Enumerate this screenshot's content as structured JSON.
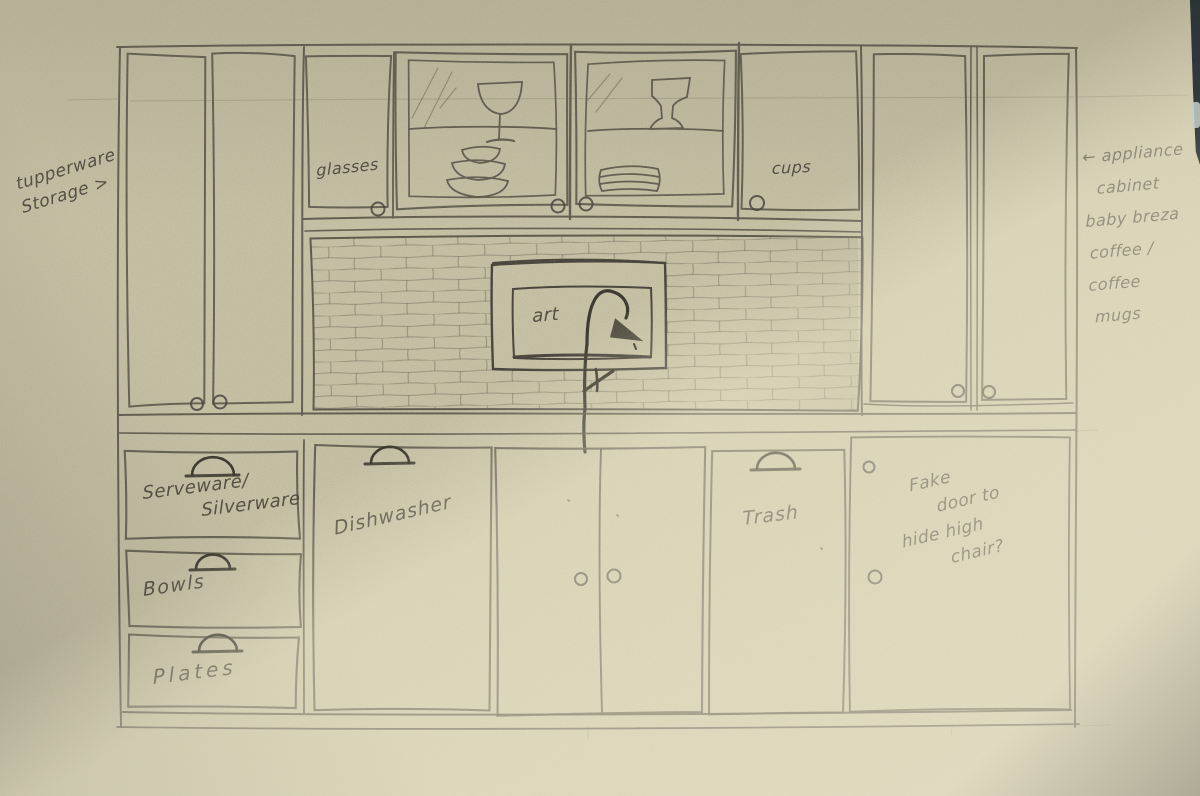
{
  "notes": {
    "left": {
      "lines": [
        "tupperware",
        "Storage >"
      ]
    },
    "right": {
      "lines": [
        "← appliance",
        "cabinet",
        "baby breza",
        "coffee /",
        "coffee",
        "mugs"
      ]
    }
  },
  "upper_cabinets": {
    "glasses": "glasses",
    "cups": "cups",
    "art": "art"
  },
  "lower_cabinets": {
    "drawer_top": {
      "lines": [
        "Serveware/",
        "Silverware"
      ]
    },
    "drawer_middle": "Bowls",
    "drawer_bottom": "Plates",
    "dishwasher": "Dishwasher",
    "trash": "Trash",
    "fake_door": {
      "lines": [
        "Fake",
        "door to",
        "hide high",
        "chair?"
      ]
    }
  },
  "icons": {
    "faucet": "faucet-icon",
    "wine_glass": "wine-glass-icon",
    "goblet": "goblet-icon",
    "bowl_stack": "bowl-stack-icon",
    "plate_stack": "plate-stack-icon",
    "drawer_pull": "half-round-pull-icon",
    "door_knob": "round-knob-icon",
    "art_frame": "art-frame"
  },
  "colors": {
    "paper": "#c7c1a5",
    "pencil": "#565246",
    "sunbeam": "#efe7c6",
    "photo_edge": "#31383c"
  }
}
